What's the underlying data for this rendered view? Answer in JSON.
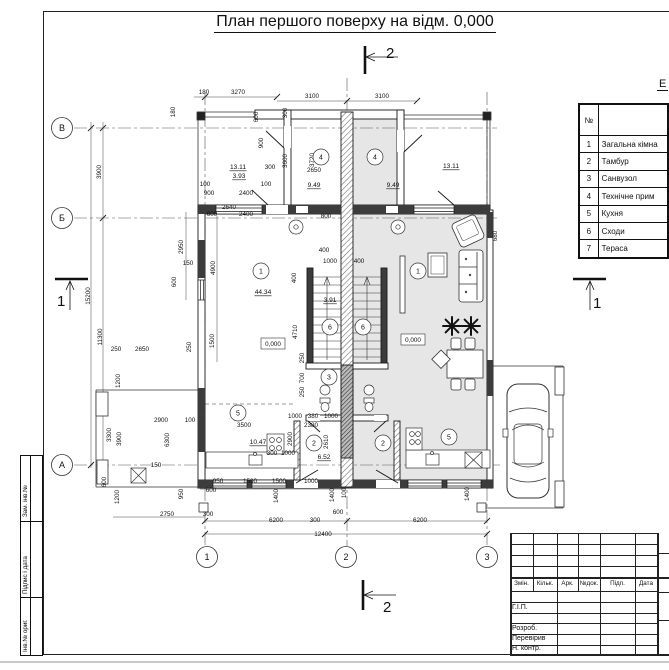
{
  "page": {
    "title": "План першого поверху на відм. 0,000"
  },
  "colors": {
    "line": "#1a1a1a",
    "unit_shade": "#e6e6e6",
    "pier": "#3c3c3c",
    "page_edge": "#c9c9c9"
  },
  "section_marks": {
    "top": "2",
    "bottom": "2",
    "left": "1",
    "right": "1"
  },
  "axes": {
    "rows": [
      {
        "label": "В",
        "x": 62,
        "y": 128
      },
      {
        "label": "Б",
        "x": 62,
        "y": 218
      },
      {
        "label": "А",
        "x": 62,
        "y": 465
      }
    ],
    "cols": [
      {
        "label": "1",
        "x": 207,
        "y": 557
      },
      {
        "label": "2",
        "x": 346,
        "y": 557
      },
      {
        "label": "3",
        "x": 487,
        "y": 557
      }
    ]
  },
  "schedule_table": {
    "title": "Е",
    "col_no": "№",
    "col_name": "",
    "rows": [
      {
        "no": "1",
        "name": "Загальна кімна"
      },
      {
        "no": "2",
        "name": "Тамбур"
      },
      {
        "no": "3",
        "name": "Санвузол"
      },
      {
        "no": "4",
        "name": "Технічне прим"
      },
      {
        "no": "5",
        "name": "Кухня"
      },
      {
        "no": "6",
        "name": "Сходи"
      },
      {
        "no": "7",
        "name": "Тераса"
      }
    ]
  },
  "title_block": {
    "columns": [
      "Змін.",
      "Кільк.",
      "Арк.",
      "№док.",
      "Підп.",
      "Дата"
    ],
    "rows": [
      "Г.І.П.",
      "Розроб.",
      "Перевірив",
      "Н. контр."
    ]
  },
  "side_strips": [
    "Зам. інв.№",
    "Підпис і дата",
    "Інв.№ ориг."
  ],
  "rooms": [
    {
      "num": "1",
      "x": 261,
      "y": 271
    },
    {
      "num": "1",
      "x": 418,
      "y": 271
    },
    {
      "num": "4",
      "x": 321,
      "y": 157
    },
    {
      "num": "4",
      "x": 375,
      "y": 157
    },
    {
      "num": "6",
      "x": 330,
      "y": 327
    },
    {
      "num": "6",
      "x": 363,
      "y": 327
    },
    {
      "num": "3",
      "x": 329,
      "y": 377
    },
    {
      "num": "5",
      "x": 238,
      "y": 413
    },
    {
      "num": "5",
      "x": 449,
      "y": 437
    },
    {
      "num": "2",
      "x": 314,
      "y": 443
    },
    {
      "num": "2",
      "x": 383,
      "y": 443
    }
  ],
  "areas": [
    {
      "t": "13.11",
      "x": 238,
      "y": 169
    },
    {
      "t": "3.93",
      "x": 239,
      "y": 178
    },
    {
      "t": "9.49",
      "x": 314,
      "y": 187
    },
    {
      "t": "9.49",
      "x": 393,
      "y": 187
    },
    {
      "t": "13.11",
      "x": 451,
      "y": 168
    },
    {
      "t": "44.34",
      "x": 263,
      "y": 294
    },
    {
      "t": "3.91",
      "x": 330,
      "y": 302
    },
    {
      "t": "10.47",
      "x": 258,
      "y": 444
    },
    {
      "t": "6.52",
      "x": 324,
      "y": 459
    }
  ],
  "levels": [
    {
      "t": "0,000",
      "x": 273,
      "y": 346
    },
    {
      "t": "0,000",
      "x": 413,
      "y": 342
    }
  ],
  "dims": [
    {
      "t": "180",
      "x": 204,
      "y": 94
    },
    {
      "t": "3270",
      "x": 238,
      "y": 94
    },
    {
      "t": "3100",
      "x": 312,
      "y": 98
    },
    {
      "t": "3100",
      "x": 382,
      "y": 98
    },
    {
      "t": "300",
      "x": 270,
      "y": 169
    },
    {
      "t": "2650",
      "x": 314,
      "y": 172
    },
    {
      "t": "100",
      "x": 205,
      "y": 186
    },
    {
      "t": "900",
      "x": 209,
      "y": 195
    },
    {
      "t": "2400",
      "x": 246,
      "y": 195
    },
    {
      "t": "100",
      "x": 266,
      "y": 186
    },
    {
      "t": "600",
      "x": 212,
      "y": 216
    },
    {
      "t": "2400",
      "x": 246,
      "y": 216
    },
    {
      "t": "2640",
      "x": 229,
      "y": 209
    },
    {
      "t": "800",
      "x": 326,
      "y": 218
    },
    {
      "t": "250",
      "x": 116,
      "y": 351
    },
    {
      "t": "2650",
      "x": 142,
      "y": 351
    },
    {
      "t": "400",
      "x": 324,
      "y": 252
    },
    {
      "t": "1000",
      "x": 330,
      "y": 263
    },
    {
      "t": "400",
      "x": 359,
      "y": 263
    },
    {
      "t": "150",
      "x": 188,
      "y": 265
    },
    {
      "t": "2900",
      "x": 161,
      "y": 422
    },
    {
      "t": "100",
      "x": 190,
      "y": 422
    },
    {
      "t": "3500",
      "x": 244,
      "y": 427
    },
    {
      "t": "1000",
      "x": 295,
      "y": 418
    },
    {
      "t": "380",
      "x": 313,
      "y": 418
    },
    {
      "t": "1000",
      "x": 331,
      "y": 418
    },
    {
      "t": "2380",
      "x": 311,
      "y": 427
    },
    {
      "t": "150",
      "x": 156,
      "y": 467
    },
    {
      "t": "300",
      "x": 272,
      "y": 455
    },
    {
      "t": "1000",
      "x": 288,
      "y": 455
    },
    {
      "t": "950",
      "x": 218,
      "y": 483
    },
    {
      "t": "1500",
      "x": 250,
      "y": 483
    },
    {
      "t": "1500",
      "x": 279,
      "y": 483
    },
    {
      "t": "1000",
      "x": 311,
      "y": 483
    },
    {
      "t": "600",
      "x": 211,
      "y": 492
    },
    {
      "t": "2750",
      "x": 167,
      "y": 516
    },
    {
      "t": "300",
      "x": 208,
      "y": 516
    },
    {
      "t": "6200",
      "x": 276,
      "y": 522
    },
    {
      "t": "300",
      "x": 315,
      "y": 522
    },
    {
      "t": "600",
      "x": 338,
      "y": 514
    },
    {
      "t": "6200",
      "x": 420,
      "y": 522
    },
    {
      "t": "12400",
      "x": 323,
      "y": 536
    },
    {
      "t": "180",
      "x": 175,
      "y": 112,
      "v": 1
    },
    {
      "t": "600",
      "x": 258,
      "y": 117,
      "v": 1
    },
    {
      "t": "900",
      "x": 263,
      "y": 143,
      "v": 1
    },
    {
      "t": "300",
      "x": 287,
      "y": 113,
      "v": 1
    },
    {
      "t": "3600",
      "x": 287,
      "y": 161,
      "v": 1
    },
    {
      "t": "3720",
      "x": 314,
      "y": 160,
      "v": 1
    },
    {
      "t": "3900",
      "x": 101,
      "y": 172,
      "v": 1
    },
    {
      "t": "15200",
      "x": 90,
      "y": 296,
      "v": 1
    },
    {
      "t": "11300",
      "x": 102,
      "y": 337,
      "v": 1
    },
    {
      "t": "2950",
      "x": 183,
      "y": 247,
      "v": 1
    },
    {
      "t": "600",
      "x": 176,
      "y": 282,
      "v": 1
    },
    {
      "t": "4900",
      "x": 215,
      "y": 268,
      "v": 1
    },
    {
      "t": "1500",
      "x": 214,
      "y": 341,
      "v": 1
    },
    {
      "t": "250",
      "x": 191,
      "y": 347,
      "v": 1
    },
    {
      "t": "400",
      "x": 296,
      "y": 278,
      "v": 1
    },
    {
      "t": "4710",
      "x": 297,
      "y": 332,
      "v": 1
    },
    {
      "t": "250",
      "x": 304,
      "y": 358,
      "v": 1
    },
    {
      "t": "700",
      "x": 304,
      "y": 378,
      "v": 1
    },
    {
      "t": "250",
      "x": 304,
      "y": 392,
      "v": 1
    },
    {
      "t": "2900",
      "x": 292,
      "y": 439,
      "v": 1
    },
    {
      "t": "2610",
      "x": 328,
      "y": 442,
      "v": 1
    },
    {
      "t": "1200",
      "x": 120,
      "y": 381,
      "v": 1
    },
    {
      "t": "3300",
      "x": 111,
      "y": 435,
      "v": 1
    },
    {
      "t": "3900",
      "x": 121,
      "y": 439,
      "v": 1
    },
    {
      "t": "6300",
      "x": 169,
      "y": 440,
      "v": 1
    },
    {
      "t": "600",
      "x": 106,
      "y": 482,
      "v": 1
    },
    {
      "t": "1200",
      "x": 119,
      "y": 497,
      "v": 1
    },
    {
      "t": "950",
      "x": 183,
      "y": 494,
      "v": 1
    },
    {
      "t": "1400",
      "x": 278,
      "y": 496,
      "v": 1
    },
    {
      "t": "1400",
      "x": 334,
      "y": 495,
      "v": 1
    },
    {
      "t": "100",
      "x": 346,
      "y": 493,
      "v": 1
    },
    {
      "t": "1400",
      "x": 469,
      "y": 494,
      "v": 1
    },
    {
      "t": "680",
      "x": 497,
      "y": 236,
      "v": 1
    }
  ]
}
